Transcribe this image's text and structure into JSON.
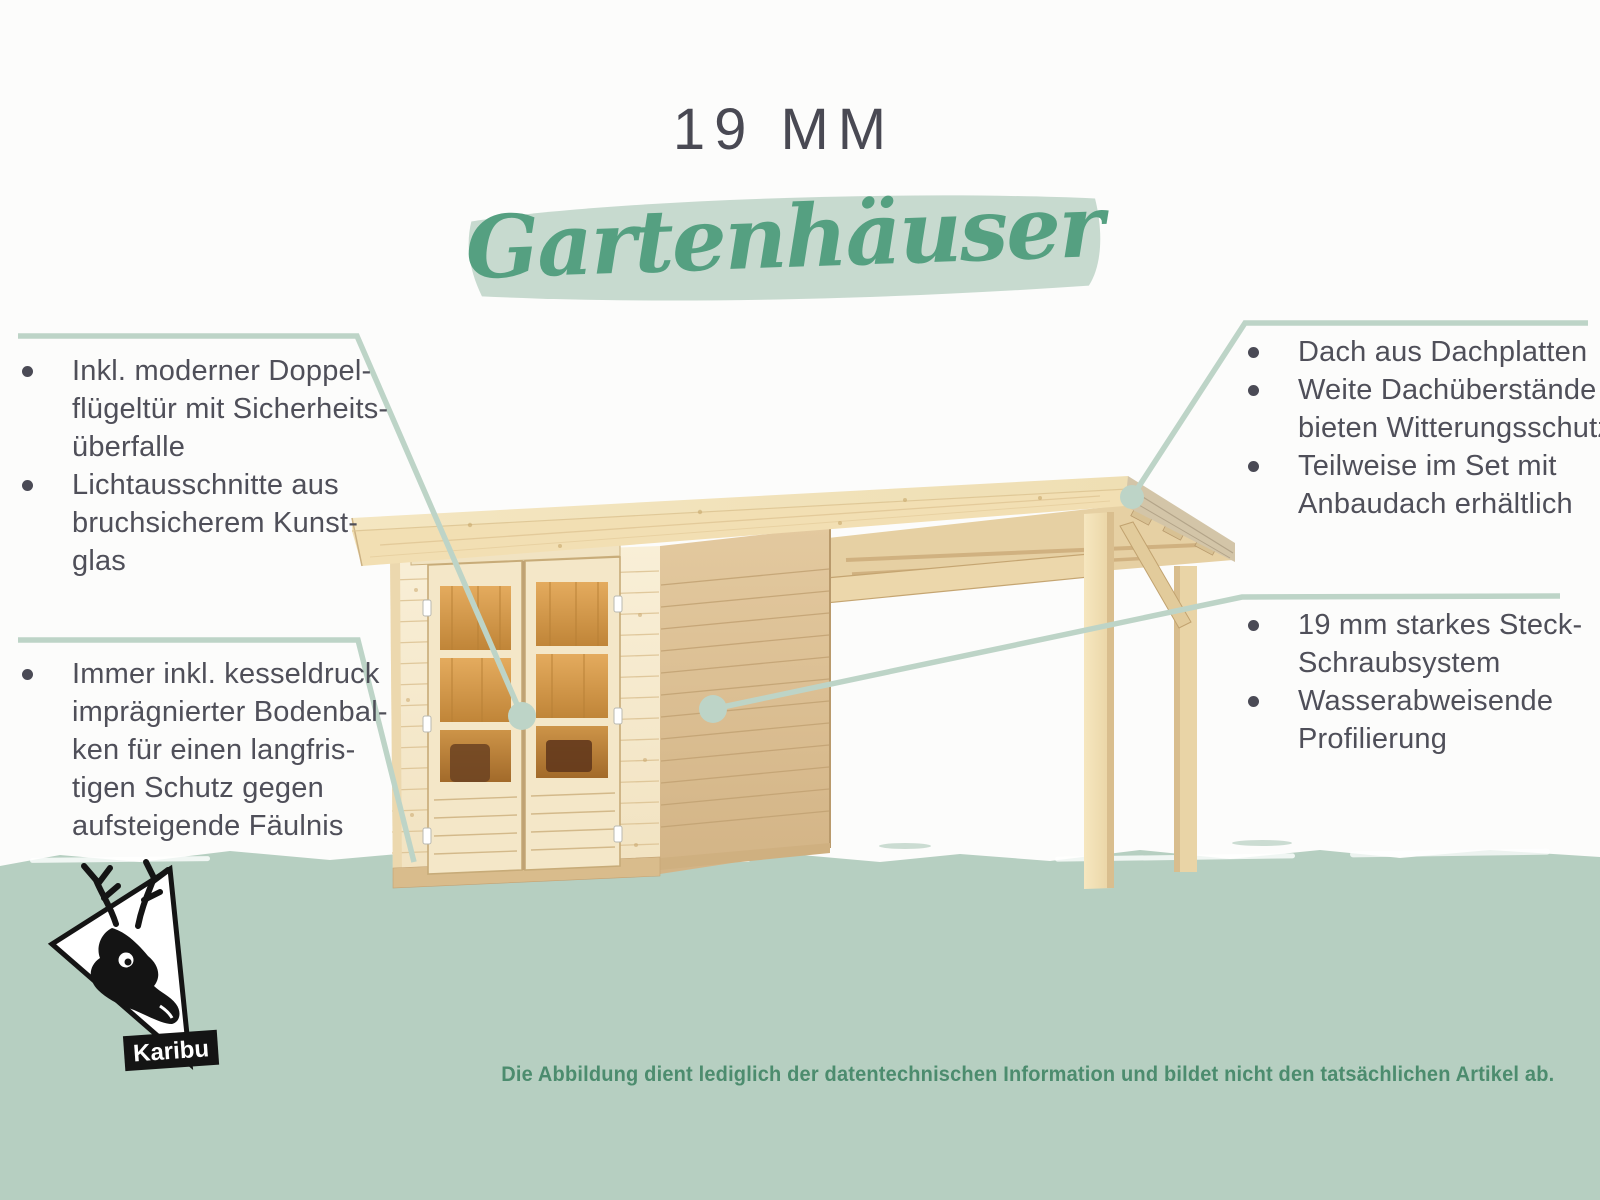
{
  "header": {
    "title": "19 MM",
    "subtitle": "Gartenhäuser"
  },
  "callouts": {
    "left_top": {
      "items": [
        {
          "lines": [
            "Inkl. moderner Doppel-",
            "flügeltür mit Sicherheits-",
            "überfalle"
          ]
        },
        {
          "lines": [
            "Lichtausschnitte aus",
            "bruchsicherem Kunst-",
            "glas"
          ]
        }
      ]
    },
    "left_bottom": {
      "items": [
        {
          "lines": [
            "Immer inkl. kesseldruck",
            "imprägnierter Bodenbal-",
            "ken für einen langfris-",
            "tigen Schutz gegen",
            "aufsteigende Fäulnis"
          ]
        }
      ]
    },
    "right_top": {
      "items": [
        {
          "lines": [
            "Dach aus Dachplatten"
          ]
        },
        {
          "lines": [
            "Weite Dachüberstände",
            "bieten Witterungsschutz"
          ]
        },
        {
          "lines": [
            "Teilweise im Set mit",
            "Anbaudach erhältlich"
          ]
        }
      ]
    },
    "right_bottom": {
      "items": [
        {
          "lines": [
            "19 mm starkes Steck-",
            "Schraubsystem"
          ]
        },
        {
          "lines": [
            "Wasserabweisende",
            "Profilierung"
          ]
        }
      ]
    }
  },
  "footer": {
    "disclaimer": "Die Abbildung dient lediglich der datentechnischen Information und bildet nicht den tatsächlichen Artikel ab."
  },
  "logo": {
    "brand": "Karibu",
    "icon": "deer-icon"
  },
  "colors": {
    "sage": "#bdd4c7",
    "band": "#b6cfc1",
    "script": "#55a081",
    "ink": "#4f4f59",
    "disc": "#4c8c6e",
    "title": "#494953"
  }
}
